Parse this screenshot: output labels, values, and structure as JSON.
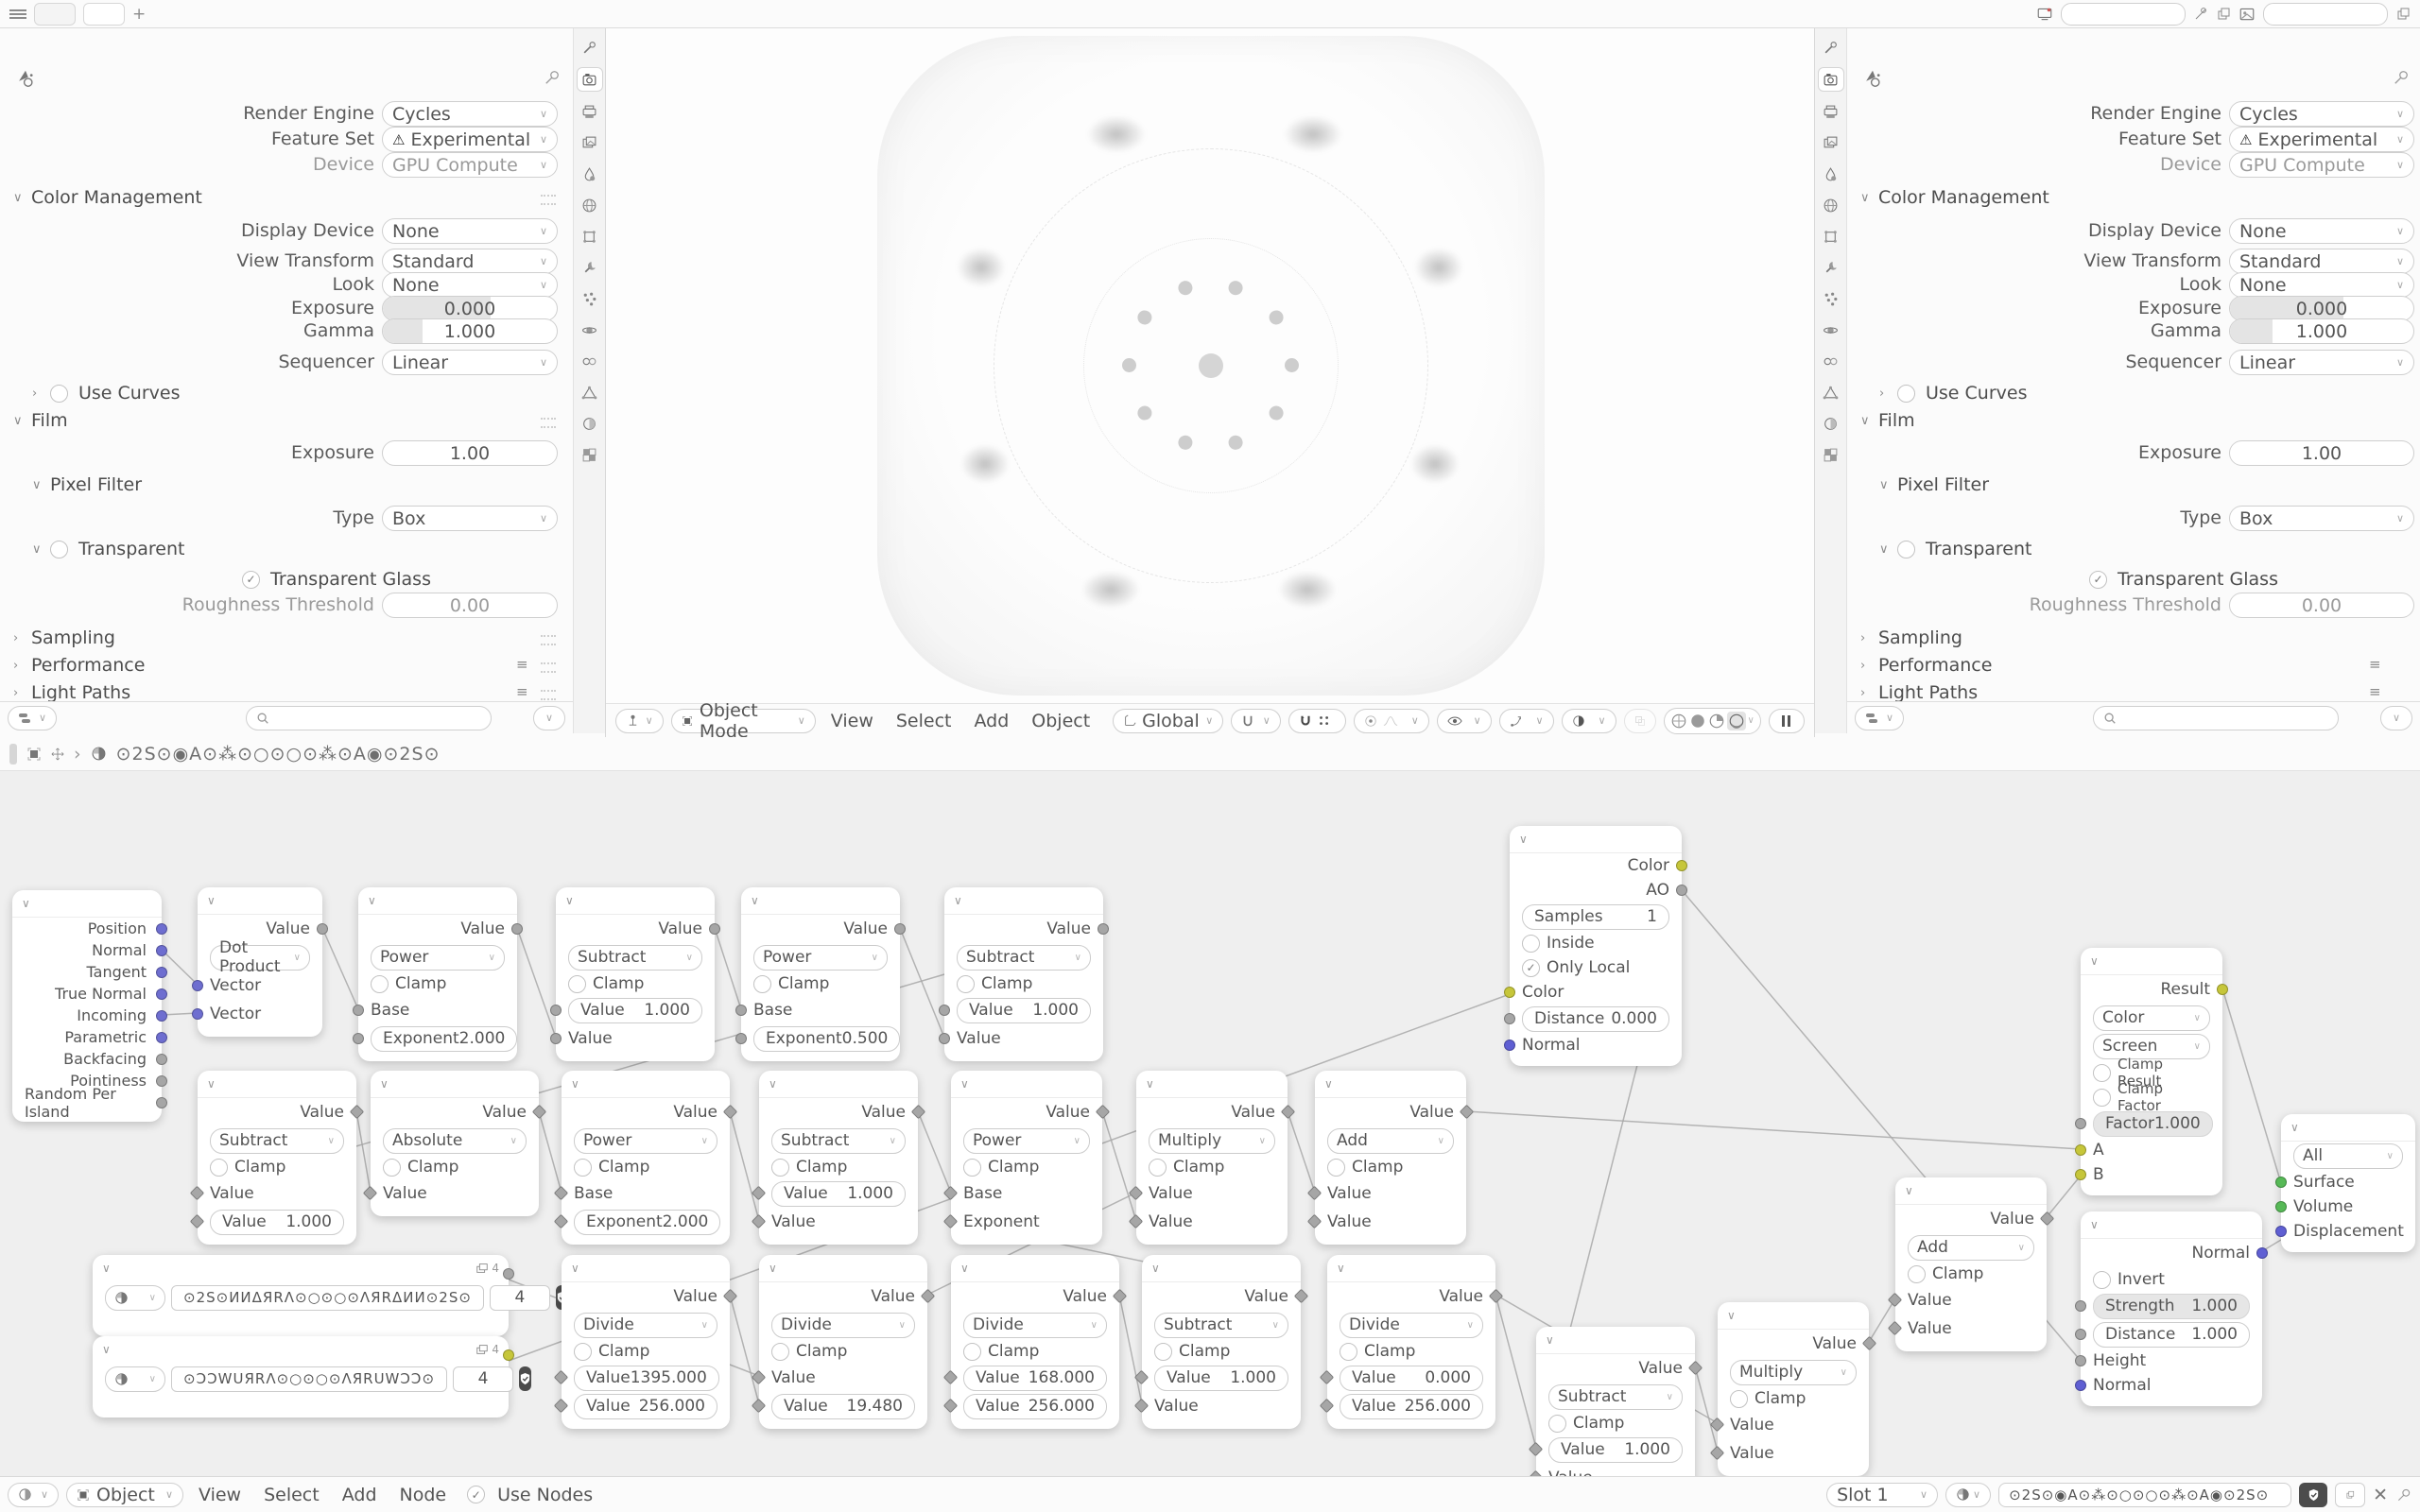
{
  "topbar": {
    "add_tab_label": "+"
  },
  "properties": {
    "render_engine_label": "Render Engine",
    "render_engine_value": "Cycles",
    "feature_set_label": "Feature Set",
    "feature_set_value": "Experimental",
    "device_label": "Device",
    "device_value": "GPU Compute",
    "color_management": {
      "title": "Color Management",
      "display_device_label": "Display Device",
      "display_device_value": "None",
      "view_transform_label": "View Transform",
      "view_transform_value": "Standard",
      "look_label": "Look",
      "look_value": "None",
      "exposure_label": "Exposure",
      "exposure_value": "0.000",
      "gamma_label": "Gamma",
      "gamma_value": "1.000",
      "sequencer_label": "Sequencer",
      "sequencer_value": "Linear",
      "use_curves_label": "Use Curves"
    },
    "film": {
      "title": "Film",
      "exposure_label": "Exposure",
      "exposure_value": "1.00",
      "pixel_filter_title": "Pixel Filter",
      "type_label": "Type",
      "type_value": "Box",
      "transparent_title": "Transparent",
      "transparent_glass_label": "Transparent Glass",
      "roughness_threshold_label": "Roughness Threshold",
      "roughness_threshold_value": "0.00"
    },
    "sections": {
      "sampling": "Sampling",
      "performance": "Performance",
      "light_paths": "Light Paths",
      "debug": "Debug"
    }
  },
  "viewport": {
    "mode": "Object Mode",
    "menus": [
      "View",
      "Select",
      "Add",
      "Object"
    ],
    "orientation": "Global"
  },
  "node_editor": {
    "breadcrumb_material": "⊙2S⊙◉A⊙⁂⊙○⊙○⊙⁂⊙A◉⊙2S⊙",
    "footer": {
      "object": "Object",
      "menus": [
        "View",
        "Select",
        "Add",
        "Node"
      ],
      "use_nodes": "Use Nodes",
      "slot": "Slot 1",
      "material_name": "⊙2S⊙◉A⊙⁂⊙○⊙○⊙⁂⊙A◉⊙2S⊙",
      "close_label": "✕"
    }
  },
  "common": {
    "value": "Value",
    "clamp": "Clamp",
    "base": "Base",
    "exponent": "Exponent",
    "vector": "Vector"
  },
  "nodes": {
    "geo": {
      "outputs": [
        "Position",
        "Normal",
        "Tangent",
        "True Normal",
        "Incoming",
        "Parametric",
        "Backfacing",
        "Pointiness",
        "Random Per Island"
      ]
    },
    "dot": {
      "op": "Dot Product"
    },
    "pow1": {
      "op": "Power",
      "exp_value": "2.000"
    },
    "sub1": {
      "op": "Subtract",
      "f_value": "1.000"
    },
    "pow2": {
      "op": "Power",
      "exp_value": "0.500"
    },
    "sub2": {
      "op": "Subtract",
      "f_value": "1.000"
    },
    "sub3": {
      "op": "Subtract",
      "f_value": "1.000"
    },
    "abs1": {
      "op": "Absolute"
    },
    "pow3": {
      "op": "Power",
      "exp_value": "2.000"
    },
    "sub4": {
      "op": "Subtract",
      "f_value": "1.000"
    },
    "pow4": {
      "op": "Power"
    },
    "mul1": {
      "op": "Multiply"
    },
    "add1": {
      "op": "Add"
    },
    "tex1": {
      "name": "⊙2S⊙ИИΔЯRΛ⊙○⊙○⊙ΛЯRΔИИ⊙2S⊙",
      "users": "4",
      "badge": "4"
    },
    "tex2": {
      "name": "⊙ƆƆWUЯRΛ⊙○⊙○⊙ΛЯRUWƆƆ⊙",
      "users": "4",
      "badge": "4"
    },
    "div1": {
      "op": "Divide",
      "f1_value": "1395.000",
      "f2_value": "256.000"
    },
    "div2": {
      "op": "Divide",
      "f_value": "19.480"
    },
    "div3": {
      "op": "Divide",
      "f1_value": "168.000",
      "f2_value": "256.000"
    },
    "sub5": {
      "op": "Subtract",
      "f_value": "1.000"
    },
    "div4": {
      "op": "Divide",
      "f1_value": "0.000",
      "f2_value": "256.000"
    },
    "ao": {
      "out_color": "Color",
      "out_ao": "AO",
      "samples_label": "Samples",
      "samples_value": "1",
      "inside_label": "Inside",
      "only_local_label": "Only Local",
      "in_color": "Color",
      "distance_label": "Distance",
      "distance_value": "0.000",
      "in_normal": "Normal"
    },
    "sub6": {
      "op": "Subtract",
      "f_value": "1.000"
    },
    "mul2": {
      "op": "Multiply"
    },
    "add2": {
      "op": "Add"
    },
    "mix": {
      "out": "Result",
      "type": "Color",
      "blend": "Screen",
      "clamp_result": "Clamp Result",
      "clamp_factor": "Clamp Factor",
      "factor_label": "Factor",
      "factor_value": "1.000",
      "a": "A",
      "b": "B"
    },
    "bump": {
      "out": "Normal",
      "invert_label": "Invert",
      "strength_label": "Strength",
      "strength_value": "1.000",
      "distance_label": "Distance",
      "distance_value": "1.000",
      "height_label": "Height",
      "normal_label": "Normal"
    },
    "outnode": {
      "target": "All",
      "surface": "Surface",
      "volume": "Volume",
      "displacement": "Displacement"
    }
  }
}
